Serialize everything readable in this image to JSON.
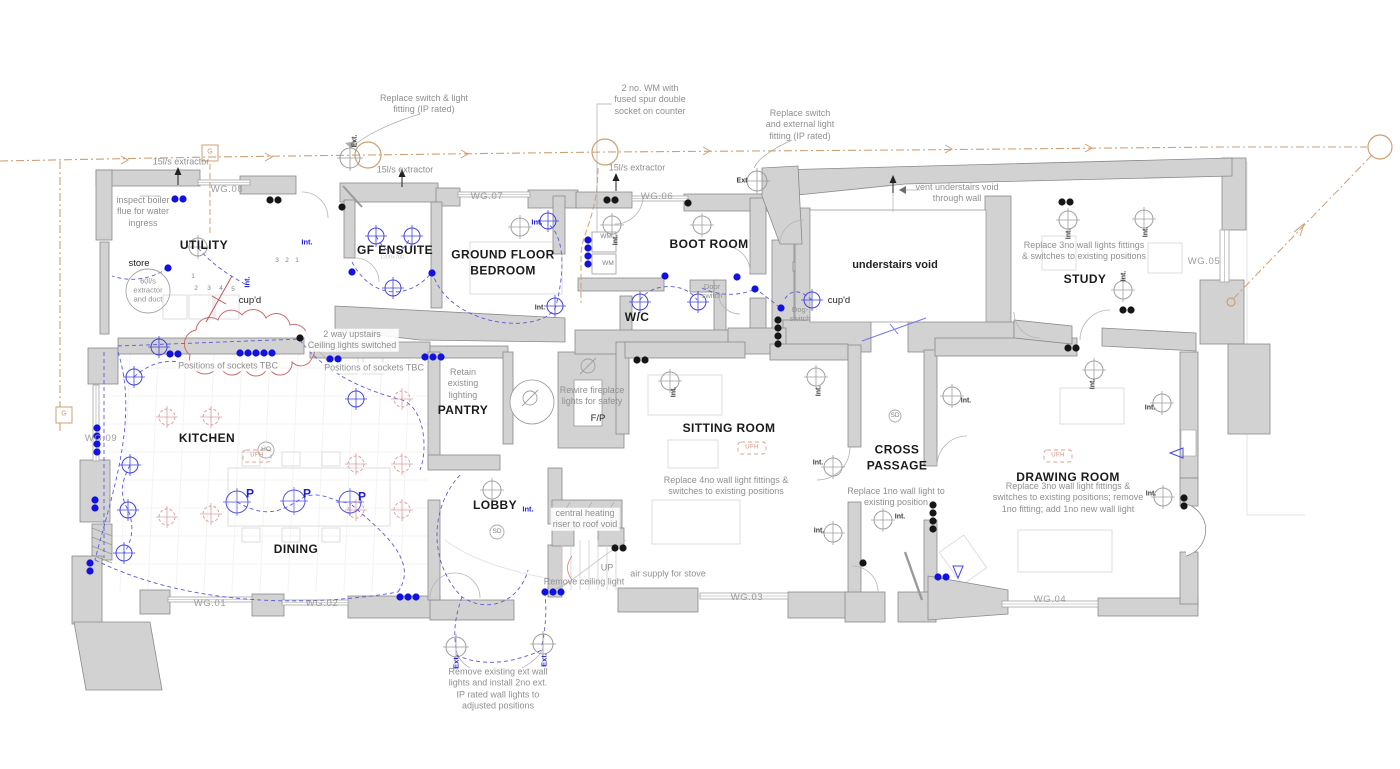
{
  "colors": {
    "wall_fill": "#d2d2d2",
    "wall_stroke": "#8a8a8a",
    "annotation": "#8f8f8f",
    "electric_blue": "#1d1dcf",
    "proposed_salmon": "#d89c9c",
    "service_orange": "#cf9f72",
    "cloud_red": "#c87070"
  },
  "rooms": [
    {
      "text": "UTILITY",
      "x": 204,
      "y": 246,
      "name": "room-label-utility"
    },
    {
      "text": "GF ENSUITE",
      "x": 395,
      "y": 251,
      "name": "room-label-gf-ensuite"
    },
    {
      "text": "GROUND FLOOR\nBEDROOM",
      "x": 503,
      "y": 263,
      "name": "room-label-ground-floor-bedroom"
    },
    {
      "text": "BOOT ROOM",
      "x": 709,
      "y": 245,
      "name": "room-label-boot-room"
    },
    {
      "text": "W/C",
      "x": 637,
      "y": 318,
      "name": "room-label-wc"
    },
    {
      "text": "STUDY",
      "x": 1085,
      "y": 280,
      "name": "room-label-study"
    },
    {
      "text": "KITCHEN",
      "x": 207,
      "y": 439,
      "name": "room-label-kitchen"
    },
    {
      "text": "DINING",
      "x": 296,
      "y": 550,
      "name": "room-label-dining"
    },
    {
      "text": "PANTRY",
      "x": 463,
      "y": 411,
      "name": "room-label-pantry"
    },
    {
      "text": "LOBBY",
      "x": 495,
      "y": 506,
      "name": "room-label-lobby"
    },
    {
      "text": "SITTING ROOM",
      "x": 729,
      "y": 429,
      "name": "room-label-sitting-room"
    },
    {
      "text": "CROSS\nPASSAGE",
      "x": 897,
      "y": 458,
      "name": "room-label-cross-passage"
    },
    {
      "text": "DRAWING ROOM",
      "x": 1068,
      "y": 478,
      "name": "room-label-drawing-room"
    },
    {
      "text": "understairs void",
      "x": 895,
      "y": 266,
      "cls": "void",
      "name": "area-label-understairs-void"
    },
    {
      "text": "cup'd",
      "x": 250,
      "y": 301,
      "cls": "dark",
      "name": "area-label-cupboard-utility"
    },
    {
      "text": "cup'd",
      "x": 839,
      "y": 301,
      "cls": "dark",
      "name": "area-label-cupboard-hall"
    },
    {
      "text": "store",
      "x": 139,
      "y": 264,
      "cls": "dark",
      "name": "area-label-store"
    },
    {
      "text": "F/P",
      "x": 598,
      "y": 419,
      "cls": "dark",
      "name": "area-label-fireplace"
    },
    {
      "text": "UP",
      "x": 607,
      "y": 568,
      "cls": "ann",
      "name": "stairs-up-label"
    },
    {
      "text": "WM",
      "x": 606,
      "y": 237,
      "cls": "tiny",
      "name": "washing-machine-label"
    },
    {
      "text": "WM",
      "x": 608,
      "y": 264,
      "cls": "tiny",
      "name": "washing-machine-label"
    }
  ],
  "annotations": [
    {
      "text": "Replace  switch & light\nfitting (IP rated)",
      "x": 424,
      "y": 104,
      "name": "annotation-replace-switch-light"
    },
    {
      "text": "2 no. WM with\nfused spur double\nsocket on counter",
      "x": 650,
      "y": 100,
      "name": "annotation-wm-fused-spur"
    },
    {
      "text": "Replace switch\nand external light\nfitting (IP rated)",
      "x": 800,
      "y": 125,
      "name": "annotation-replace-external-light"
    },
    {
      "text": "15l/s extractor",
      "x": 181,
      "y": 162,
      "name": "annotation-extractor-utility"
    },
    {
      "text": "15l/s extractor",
      "x": 405,
      "y": 170,
      "name": "annotation-extractor-ensuite"
    },
    {
      "text": "15l/s extractor",
      "x": 637,
      "y": 168,
      "name": "annotation-extractor-bootroom"
    },
    {
      "text": "vent understairs void\nthrough wall",
      "x": 957,
      "y": 193,
      "name": "annotation-vent-understairs"
    },
    {
      "text": "inspect boiler\nflue for water\ningress",
      "x": 143,
      "y": 212,
      "name": "annotation-inspect-boiler"
    },
    {
      "text": "Replace 3no wall lights fittings\n& switches to existing positions",
      "x": 1084,
      "y": 251,
      "name": "annotation-study-wall-lights"
    },
    {
      "text": "2 way upstairs\nCeiling lights switched",
      "x": 352,
      "y": 340,
      "cls": "ann boxed",
      "name": "annotation-two-way-upstairs"
    },
    {
      "text": "Positions of sockets TBC",
      "x": 228,
      "y": 366,
      "cls": "ann boxed",
      "name": "annotation-sockets-tbc-1"
    },
    {
      "text": "Positions of sockets TBC",
      "x": 374,
      "y": 368,
      "cls": "ann boxed",
      "name": "annotation-sockets-tbc-2"
    },
    {
      "text": "Retain\nexisting\nlighting",
      "x": 463,
      "y": 384,
      "cls": "ann boxed",
      "name": "annotation-retain-lighting"
    },
    {
      "text": "Rewire fireplace\nlights for safety",
      "x": 592,
      "y": 396,
      "name": "annotation-rewire-fireplace"
    },
    {
      "text": "Replace 4no wall light fittings &\nswitches to existing positions",
      "x": 726,
      "y": 486,
      "name": "annotation-sitting-wall-lights"
    },
    {
      "text": "Replace 1no wall light to\nexisting position",
      "x": 896,
      "y": 497,
      "name": "annotation-cross-wall-light"
    },
    {
      "text": "Replace 3no wall light fittings &\nswitches to existing positions; remove\n1no fitting; add 1no new wall light",
      "x": 1068,
      "y": 498,
      "name": "annotation-drawing-wall-lights"
    },
    {
      "text": "central heating\nriser to roof void",
      "x": 585,
      "y": 519,
      "cls": "ann boxed",
      "name": "annotation-central-heating-riser"
    },
    {
      "text": "air supply for stove",
      "x": 668,
      "y": 574,
      "name": "annotation-air-supply"
    },
    {
      "text": "Remove ceiling light",
      "x": 584,
      "y": 582,
      "name": "annotation-remove-ceiling-light"
    },
    {
      "text": "Remove existing ext wall\nlights and install 2no ext.\nIP rated wall lights to\nadjusted positions",
      "x": 498,
      "y": 689,
      "name": "annotation-remove-ext-wall-lights"
    },
    {
      "text": "60l/s\nextractor\nand duct",
      "x": 148,
      "y": 290,
      "cls": "ann-sm",
      "name": "annotation-60ls-extractor"
    },
    {
      "text": "Door\nswitch",
      "x": 712,
      "y": 291,
      "cls": "ann-sm",
      "name": "annotation-door-switch"
    },
    {
      "text": "Dog-\nswitch",
      "x": 800,
      "y": 314,
      "cls": "ann-sm",
      "name": "annotation-dog-switch"
    }
  ],
  "window_tags": [
    {
      "text": "WG.08",
      "x": 227,
      "y": 190,
      "name": "window-tag-wg08"
    },
    {
      "text": "WG.07",
      "x": 487,
      "y": 197,
      "name": "window-tag-wg07"
    },
    {
      "text": "WG.06",
      "x": 657,
      "y": 197,
      "name": "window-tag-wg06"
    },
    {
      "text": "WG.05",
      "x": 1204,
      "y": 262,
      "name": "window-tag-wg05"
    },
    {
      "text": "WG.09",
      "x": 101,
      "y": 439,
      "name": "window-tag-wg09"
    },
    {
      "text": "WG.01",
      "x": 210,
      "y": 604,
      "name": "window-tag-wg01"
    },
    {
      "text": "WG.02",
      "x": 322,
      "y": 604,
      "name": "window-tag-wg02"
    },
    {
      "text": "WG.03",
      "x": 747,
      "y": 598,
      "name": "window-tag-wg03"
    },
    {
      "text": "WG.04",
      "x": 1050,
      "y": 600,
      "name": "window-tag-wg04"
    }
  ],
  "labels": [
    {
      "text": "Int.",
      "x": 307,
      "y": 242,
      "cls": "blue",
      "name": "intermediate-switch-label"
    },
    {
      "text": "Int.",
      "x": 537,
      "y": 222,
      "cls": "blue",
      "name": "intermediate-switch-label"
    },
    {
      "text": "Int.",
      "x": 528,
      "y": 509,
      "cls": "blue",
      "name": "intermediate-switch-label"
    },
    {
      "text": "Int.",
      "x": 247,
      "y": 282,
      "rot": -90,
      "cls": "blue",
      "name": "intermediate-switch-label"
    },
    {
      "text": "Int.",
      "x": 540,
      "y": 309,
      "cls": "int",
      "name": "intermediate-switch-label"
    },
    {
      "text": "Int.",
      "x": 617,
      "y": 240,
      "rot": -90,
      "cls": "int",
      "name": "intermediate-switch-label"
    },
    {
      "text": "Int.",
      "x": 675,
      "y": 392,
      "rot": -90,
      "cls": "int",
      "name": "intermediate-switch-label"
    },
    {
      "text": "Int.",
      "x": 820,
      "y": 391,
      "rot": -90,
      "cls": "int",
      "name": "intermediate-switch-label"
    },
    {
      "text": "Int.",
      "x": 818,
      "y": 464,
      "cls": "int",
      "name": "intermediate-switch-label"
    },
    {
      "text": "Int.",
      "x": 819,
      "y": 532,
      "cls": "int",
      "name": "intermediate-switch-label"
    },
    {
      "text": "Int.",
      "x": 900,
      "y": 518,
      "cls": "int",
      "name": "intermediate-switch-label"
    },
    {
      "text": "Int.",
      "x": 1070,
      "y": 234,
      "rot": -90,
      "cls": "int",
      "name": "intermediate-switch-label"
    },
    {
      "text": "Int.",
      "x": 1147,
      "y": 232,
      "rot": -90,
      "cls": "int",
      "name": "intermediate-switch-label"
    },
    {
      "text": "Int.",
      "x": 1125,
      "y": 276,
      "rot": -90,
      "cls": "int",
      "name": "intermediate-switch-label"
    },
    {
      "text": "Int.",
      "x": 966,
      "y": 402,
      "cls": "int",
      "name": "intermediate-switch-label"
    },
    {
      "text": "Int.",
      "x": 1150,
      "y": 409,
      "cls": "int",
      "name": "intermediate-switch-label"
    },
    {
      "text": "Int.",
      "x": 1151,
      "y": 495,
      "cls": "int",
      "name": "intermediate-switch-label"
    },
    {
      "text": "Int.",
      "x": 1094,
      "y": 384,
      "rot": -90,
      "cls": "int",
      "name": "intermediate-switch-label"
    },
    {
      "text": "Ext.",
      "x": 356,
      "y": 141,
      "rot": -90,
      "cls": "int",
      "name": "external-light-label"
    },
    {
      "text": "Ext",
      "x": 742,
      "y": 182,
      "cls": "int",
      "name": "external-light-label"
    },
    {
      "text": "Ext.",
      "x": 456,
      "y": 662,
      "rot": -90,
      "cls": "blue",
      "name": "external-light-label"
    },
    {
      "text": "Ext.",
      "x": 544,
      "y": 660,
      "rot": -90,
      "cls": "blue",
      "name": "external-light-label"
    },
    {
      "text": "P",
      "x": 250,
      "y": 494,
      "cls": "pend",
      "name": "pendant-label"
    },
    {
      "text": "P",
      "x": 307,
      "y": 494,
      "cls": "pend",
      "name": "pendant-label"
    },
    {
      "text": "P",
      "x": 362,
      "y": 497,
      "cls": "pend",
      "name": "pendant-label"
    },
    {
      "text": "SD",
      "x": 497,
      "y": 532,
      "cls": "tiny",
      "name": "smoke-detector-label"
    },
    {
      "text": "SD",
      "x": 895,
      "y": 416,
      "cls": "tiny",
      "name": "smoke-detector-label"
    },
    {
      "text": "HO",
      "x": 266,
      "y": 450,
      "cls": "tiny",
      "name": "heat-outlet-label"
    },
    {
      "text": "UFH",
      "x": 257,
      "y": 456,
      "cls": "salmon",
      "name": "underfloor-heating-label"
    },
    {
      "text": "UFH",
      "x": 752,
      "y": 448,
      "cls": "salmon",
      "name": "underfloor-heating-label"
    },
    {
      "text": "UFH",
      "x": 1058,
      "y": 456,
      "cls": "salmon",
      "name": "underfloor-heating-label"
    },
    {
      "text": "G",
      "x": 210,
      "y": 153,
      "cls": "orange",
      "name": "gas-marker-label"
    },
    {
      "text": "G",
      "x": 64,
      "y": 415,
      "cls": "orange",
      "name": "gas-marker-label"
    },
    {
      "text": "1",
      "x": 193,
      "y": 277,
      "cls": "tiny",
      "name": "socket-number"
    },
    {
      "text": "2",
      "x": 196,
      "y": 289,
      "cls": "tiny",
      "name": "socket-number"
    },
    {
      "text": "3",
      "x": 209,
      "y": 289,
      "cls": "tiny",
      "name": "socket-number"
    },
    {
      "text": "4",
      "x": 221,
      "y": 289,
      "cls": "tiny",
      "name": "socket-number"
    },
    {
      "text": "5",
      "x": 233,
      "y": 290,
      "cls": "tiny",
      "name": "socket-number"
    },
    {
      "text": "3",
      "x": 277,
      "y": 261,
      "cls": "tiny",
      "name": "socket-number"
    },
    {
      "text": "2",
      "x": 287,
      "y": 261,
      "cls": "tiny",
      "name": "socket-number"
    },
    {
      "text": "1",
      "x": 297,
      "y": 261,
      "cls": "tiny",
      "name": "socket-number"
    },
    {
      "text": "1200x700",
      "x": 392,
      "y": 258,
      "cls": "faint",
      "name": "dimension-label"
    }
  ]
}
